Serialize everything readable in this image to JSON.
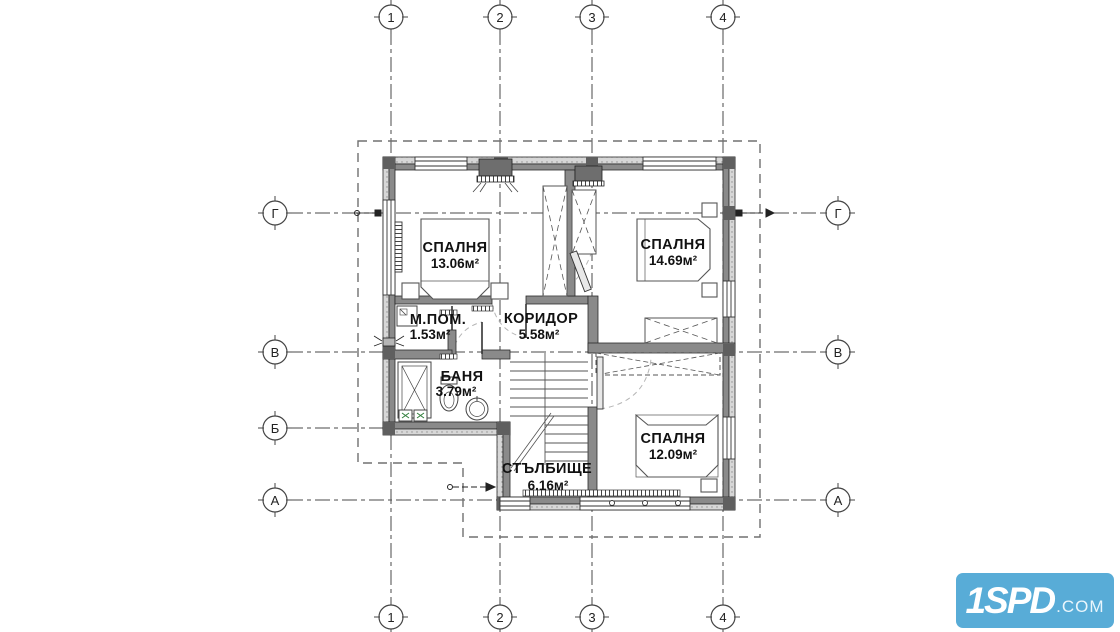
{
  "plan": {
    "rooms": [
      {
        "name": "СПАЛНЯ",
        "area": "13.06м²"
      },
      {
        "name": "СПАЛНЯ",
        "area": "14.69м²"
      },
      {
        "name": "М.ПОМ.",
        "area": "1.53м²"
      },
      {
        "name": "КОРИДОР",
        "area": "5.58м²"
      },
      {
        "name": "БАНЯ",
        "area": "3.79м²"
      },
      {
        "name": "СПАЛНЯ",
        "area": "12.09м²"
      },
      {
        "name": "СТЪЛБИЩЕ",
        "area": "6.16м²"
      }
    ],
    "axes": {
      "cols": [
        "1",
        "2",
        "3",
        "4"
      ],
      "rows_left": [
        "Г",
        "В",
        "Б",
        "А"
      ],
      "rows_right": [
        "Г",
        "В",
        "А"
      ]
    }
  },
  "watermark": {
    "brand": "1SPD",
    "suffix": ".COM",
    "bg": "#58acd7"
  },
  "colors": {
    "wall_light": "#d2d2d2",
    "wall_dark": "#8a8a8a",
    "column": "#5f5f5f",
    "line": "#333333",
    "axis_line": "#4a4a4a"
  }
}
